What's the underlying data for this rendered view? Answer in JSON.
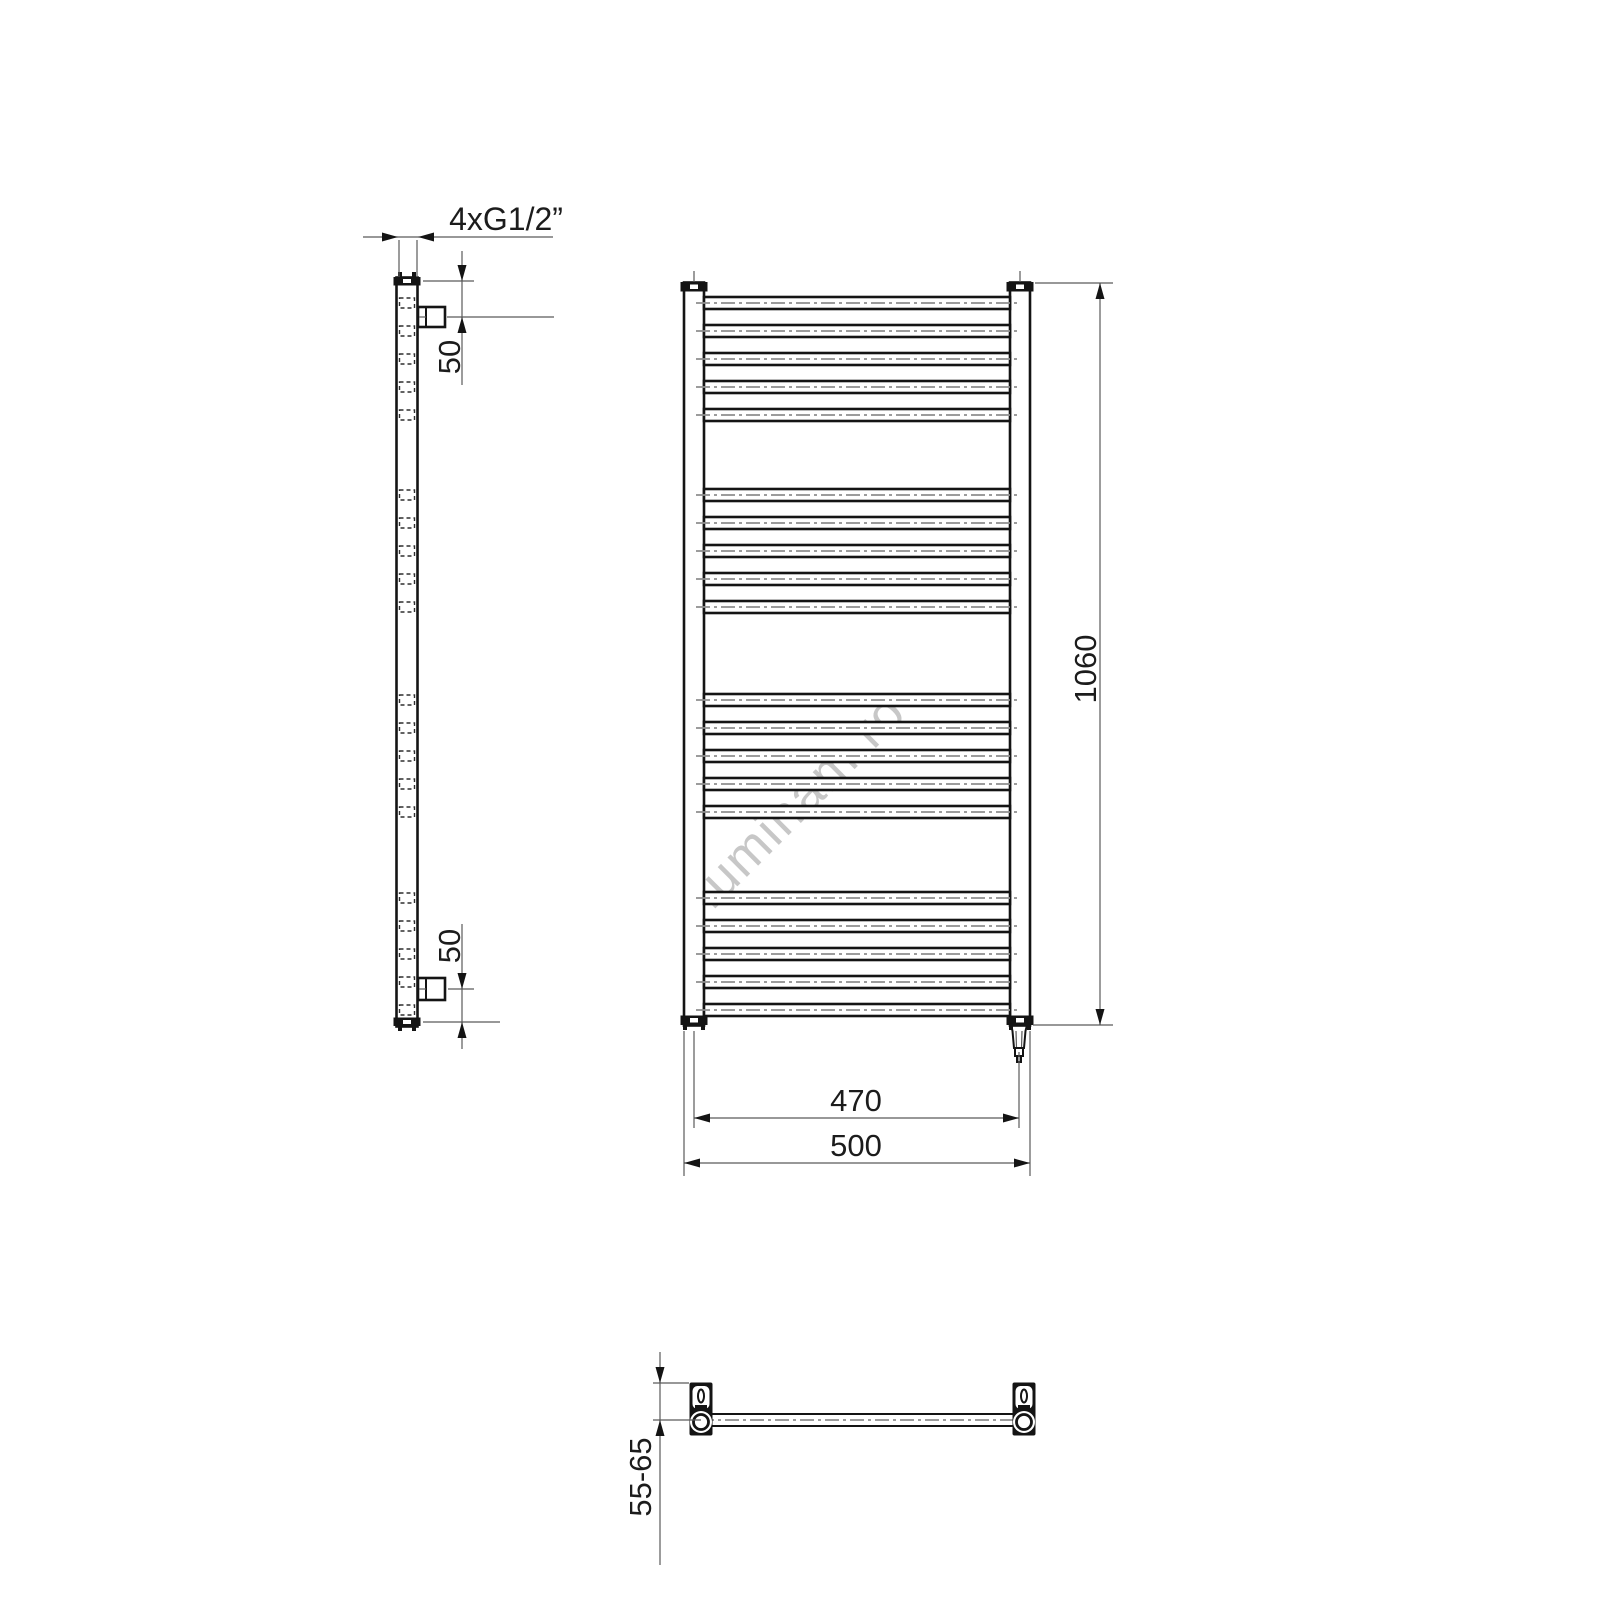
{
  "title": "Electric towel radiator technical dimension drawing",
  "watermark": "luminam.ro",
  "dimensions": {
    "connections": "4xG1/2”",
    "top_offset": "50",
    "bottom_offset": "50",
    "height": "1060",
    "center_width": "470",
    "overall_width": "500",
    "wall_distance": "55-65"
  },
  "radiator": {
    "rung_count": 20,
    "groups": 4,
    "rungs_per_group": 5,
    "rung_tops": [
      297,
      325,
      353,
      381,
      409,
      489,
      517,
      545,
      573,
      601,
      694,
      722,
      750,
      778,
      806,
      892,
      920,
      948,
      976,
      1004
    ],
    "rung_height": 12,
    "has_electric_element": true
  },
  "colors": {
    "line": "#141414",
    "thin_line": "#5a5a5a",
    "centerline": "#8f8f8f",
    "watermark": "#c7c7c7",
    "background": "#ffffff"
  }
}
